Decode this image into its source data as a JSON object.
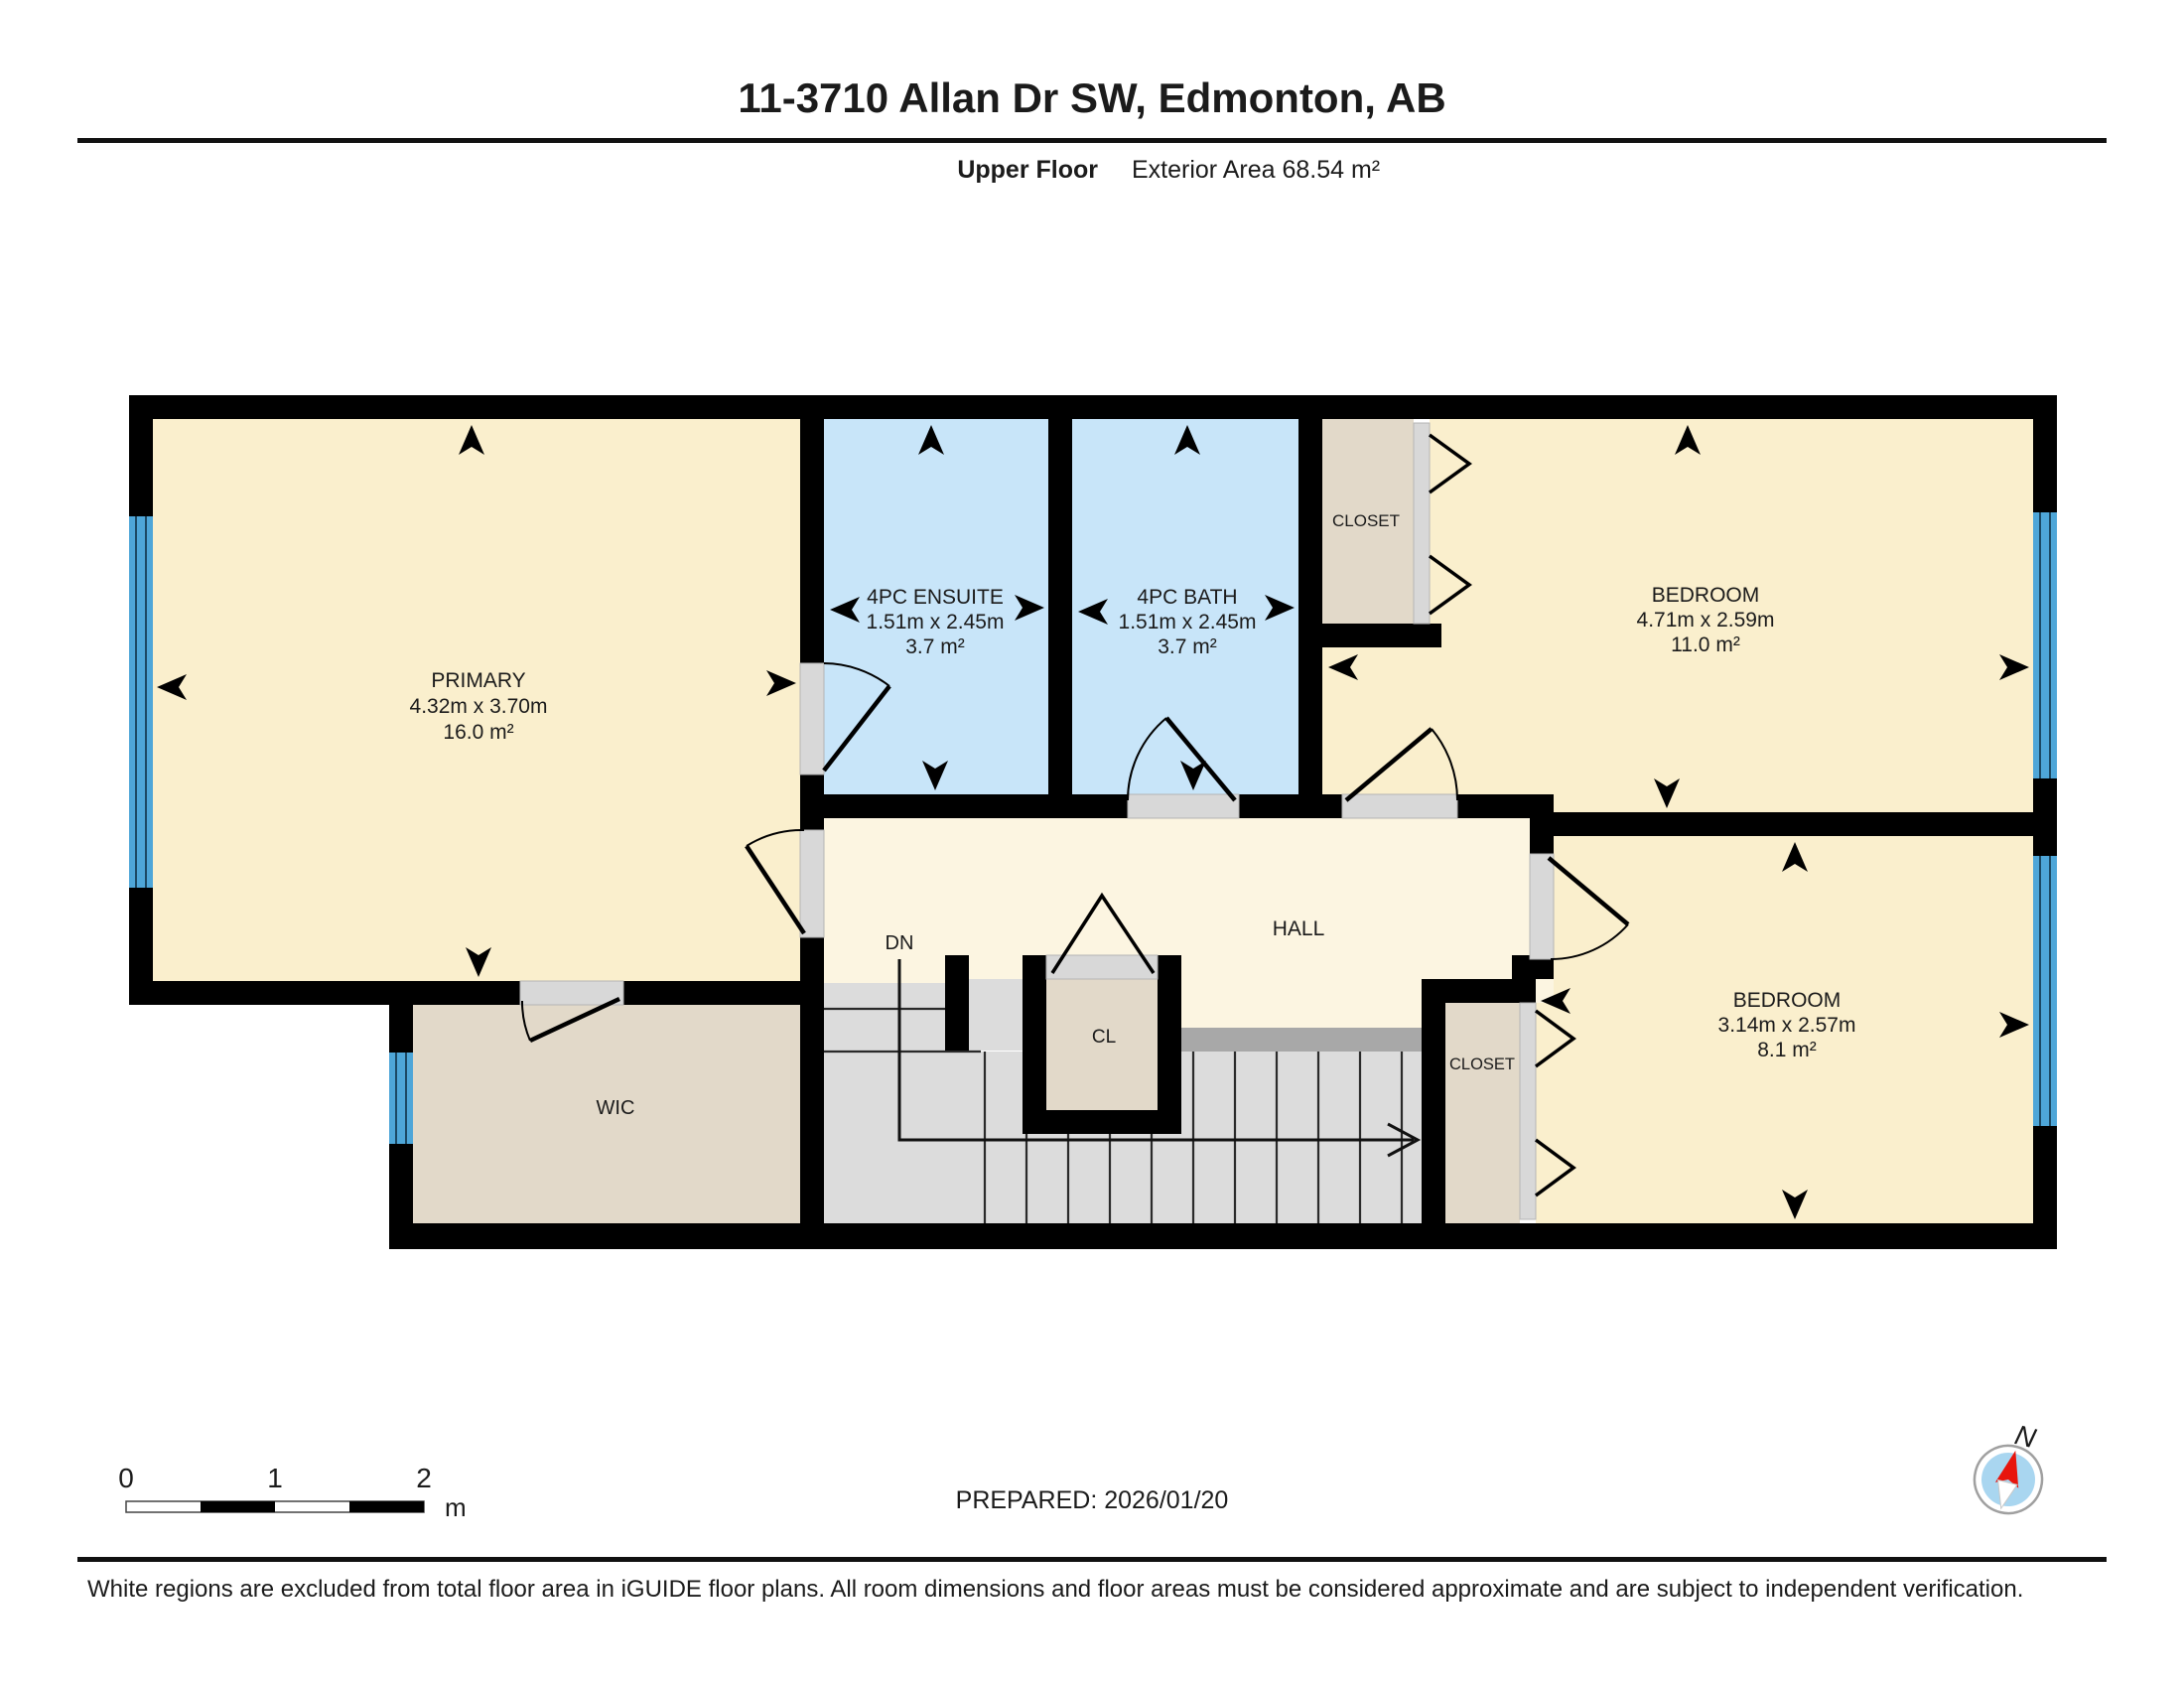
{
  "header": {
    "title": "11-3710 Allan Dr SW, Edmonton, AB",
    "floor_label": "Upper Floor",
    "area_label": "Exterior Area 68.54 m²"
  },
  "rooms": {
    "primary": {
      "name": "PRIMARY",
      "dims": "4.32m x 3.70m",
      "area": "16.0 m²"
    },
    "ensuite": {
      "name": "4PC ENSUITE",
      "dims": "1.51m x 2.45m",
      "area": "3.7 m²"
    },
    "bath": {
      "name": "4PC BATH",
      "dims": "1.51m x 2.45m",
      "area": "3.7 m²"
    },
    "bedroom_top": {
      "name": "BEDROOM",
      "dims": "4.71m x 2.59m",
      "area": "11.0 m²"
    },
    "bedroom_bottom": {
      "name": "BEDROOM",
      "dims": "3.14m x 2.57m",
      "area": "8.1 m²"
    },
    "closet_top": {
      "name": "CLOSET"
    },
    "closet_bottom": {
      "name": "CLOSET"
    },
    "wic": {
      "name": "WIC"
    },
    "hall": {
      "name": "HALL"
    },
    "cl": {
      "name": "CL"
    },
    "dn": {
      "name": "DN"
    }
  },
  "scale_bar": {
    "tick0": "0",
    "tick1": "1",
    "tick2": "2",
    "unit": "m"
  },
  "prepared_label": "PREPARED: 2026/01/20",
  "compass": {
    "north_label": "N"
  },
  "footer": "White regions are excluded from total floor area in iGUIDE floor plans. All room dimensions and floor areas must be considered approximate and are subject to independent verification.",
  "colors": {
    "room_cream": "#faefcd",
    "hall_cream": "#fcf5e1",
    "bath_blue": "#c8e5f9",
    "closet_tan": "#e2d9c9",
    "stairs_gray": "#dcdcdc",
    "strip_gray": "#a8a8a8",
    "window_blue": "#4ea6d8",
    "wall_black": "#000000",
    "needle_red": "#e8150d"
  }
}
